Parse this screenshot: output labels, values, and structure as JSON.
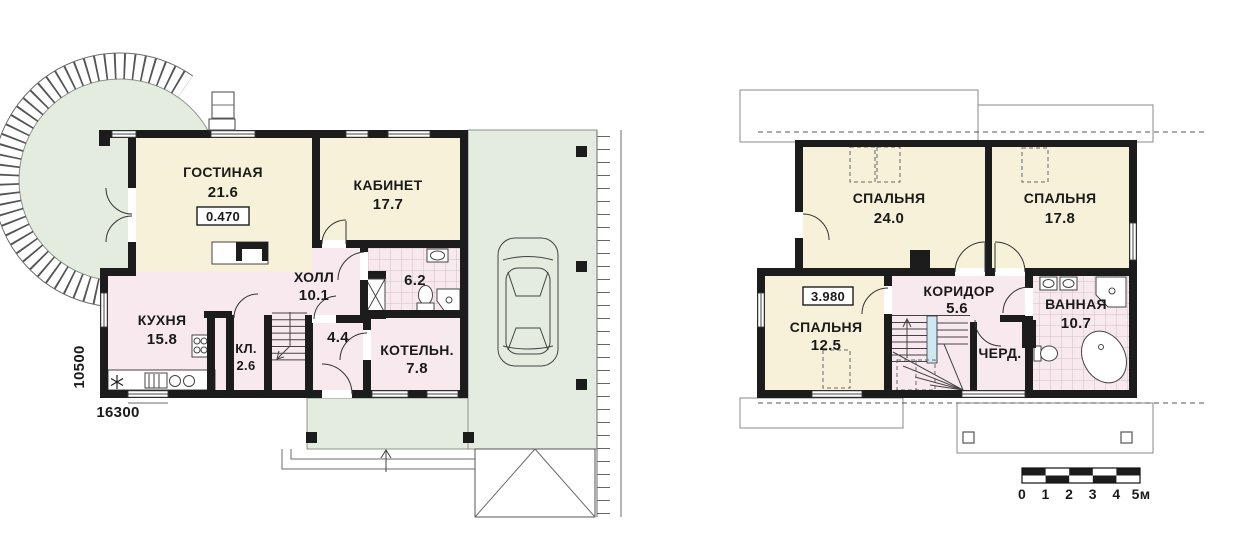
{
  "page": {
    "background": "#ffffff"
  },
  "floor1": {
    "dim_horizontal": "16300",
    "dim_vertical": "10500",
    "level_mark": "0.470",
    "rooms": [
      {
        "id": "gostinaya",
        "name": "ГОСТИНАЯ",
        "area": "21.6"
      },
      {
        "id": "kabinet",
        "name": "КАБИНЕТ",
        "area": "17.7"
      },
      {
        "id": "holl",
        "name": "ХОЛЛ",
        "area": "10.1"
      },
      {
        "id": "sanuzel",
        "name": "",
        "area": "6.2"
      },
      {
        "id": "kuhnya",
        "name": "КУХНЯ",
        "area": "15.8"
      },
      {
        "id": "kladovaya",
        "name": "КЛ.",
        "area": "2.6"
      },
      {
        "id": "tambur",
        "name": "",
        "area": "4.4"
      },
      {
        "id": "kotelnaya",
        "name": "КОТЕЛЬН.",
        "area": "7.8"
      }
    ]
  },
  "floor2": {
    "level_mark": "3.980",
    "rooms": [
      {
        "id": "spalnya-1",
        "name": "СПАЛЬНЯ",
        "area": "24.0"
      },
      {
        "id": "spalnya-2",
        "name": "СПАЛЬНЯ",
        "area": "17.8"
      },
      {
        "id": "spalnya-3",
        "name": "СПАЛЬНЯ",
        "area": "12.5"
      },
      {
        "id": "koridor",
        "name": "КОРИДОР",
        "area": "5.6"
      },
      {
        "id": "cherdak",
        "name": "ЧЕРД.",
        "area": ""
      },
      {
        "id": "vannaya",
        "name": "ВАННАЯ",
        "area": "10.7"
      }
    ]
  },
  "scale_bar": {
    "labels": [
      "0",
      "1",
      "2",
      "3",
      "4",
      "5м"
    ]
  },
  "colors": {
    "room_yellow": "#f6f1d8",
    "room_pink": "#f8e9ef",
    "outdoor_green": "#e4ecdf",
    "wall": "#1c1c1c",
    "stair_accent": "#cfe9f2"
  }
}
